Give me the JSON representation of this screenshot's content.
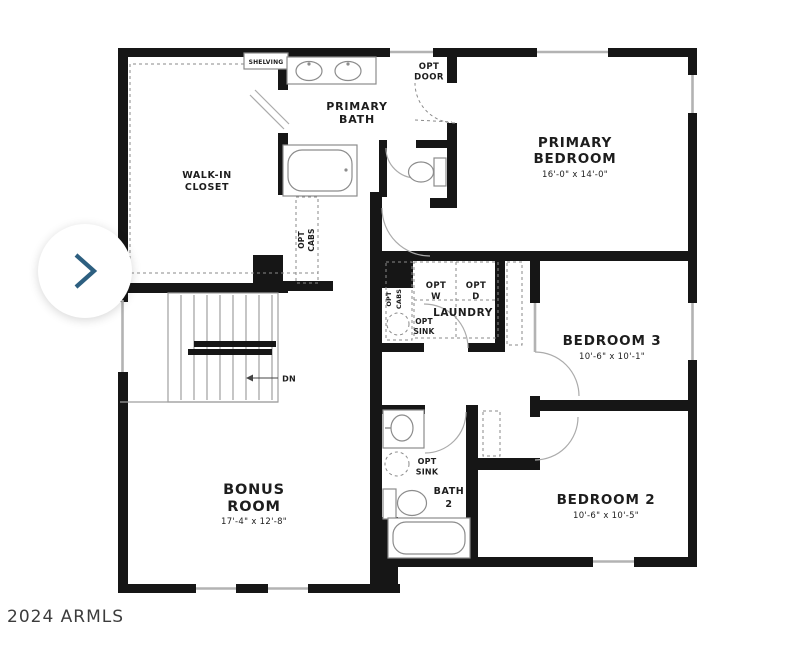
{
  "colors": {
    "wall": "#161616",
    "thin_line": "#9f9f9f",
    "text": "#1d1d1d",
    "chevron": "#2d5f80",
    "watermark": "#3c3c3c",
    "background": "#ffffff"
  },
  "nav": {
    "next_icon": "chevron-right"
  },
  "watermark": {
    "text": "2024 ARMLS"
  },
  "floorplan": {
    "rooms": {
      "primary_bedroom": {
        "name1": "PRIMARY",
        "name2": "BEDROOM",
        "dims": "16'-0\" x 14'-0\""
      },
      "primary_bath": {
        "name1": "PRIMARY",
        "name2": "BATH"
      },
      "walk_in_closet": {
        "name1": "WALK-IN",
        "name2": "CLOSET"
      },
      "bedroom_3": {
        "name": "BEDROOM 3",
        "dims": "10'-6\" x 10'-1\""
      },
      "bedroom_2": {
        "name": "BEDROOM 2",
        "dims": "10'-6\" x 10'-5\""
      },
      "bonus_room": {
        "name1": "BONUS",
        "name2": "ROOM",
        "dims": "17'-4\" x 12'-8\""
      },
      "laundry": {
        "name": "LAUNDRY"
      }
    },
    "annotations": {
      "shelving": "SHELVING",
      "opt_door1": "OPT",
      "opt_door2": "DOOR",
      "closet_opt": "OPT",
      "closet_cabs": "CABS",
      "washer1": "OPT",
      "washer2": "W",
      "dryer1": "OPT",
      "dryer2": "D",
      "laundry_opt": "OPT",
      "laundry_cabs": "CABS",
      "laundry_sink1": "OPT",
      "laundry_sink2": "SINK",
      "bath2_sink1": "OPT",
      "bath2_sink2": "SINK",
      "bath2_name1": "BATH",
      "bath2_name2": "2",
      "stairs_down": "DN"
    }
  }
}
